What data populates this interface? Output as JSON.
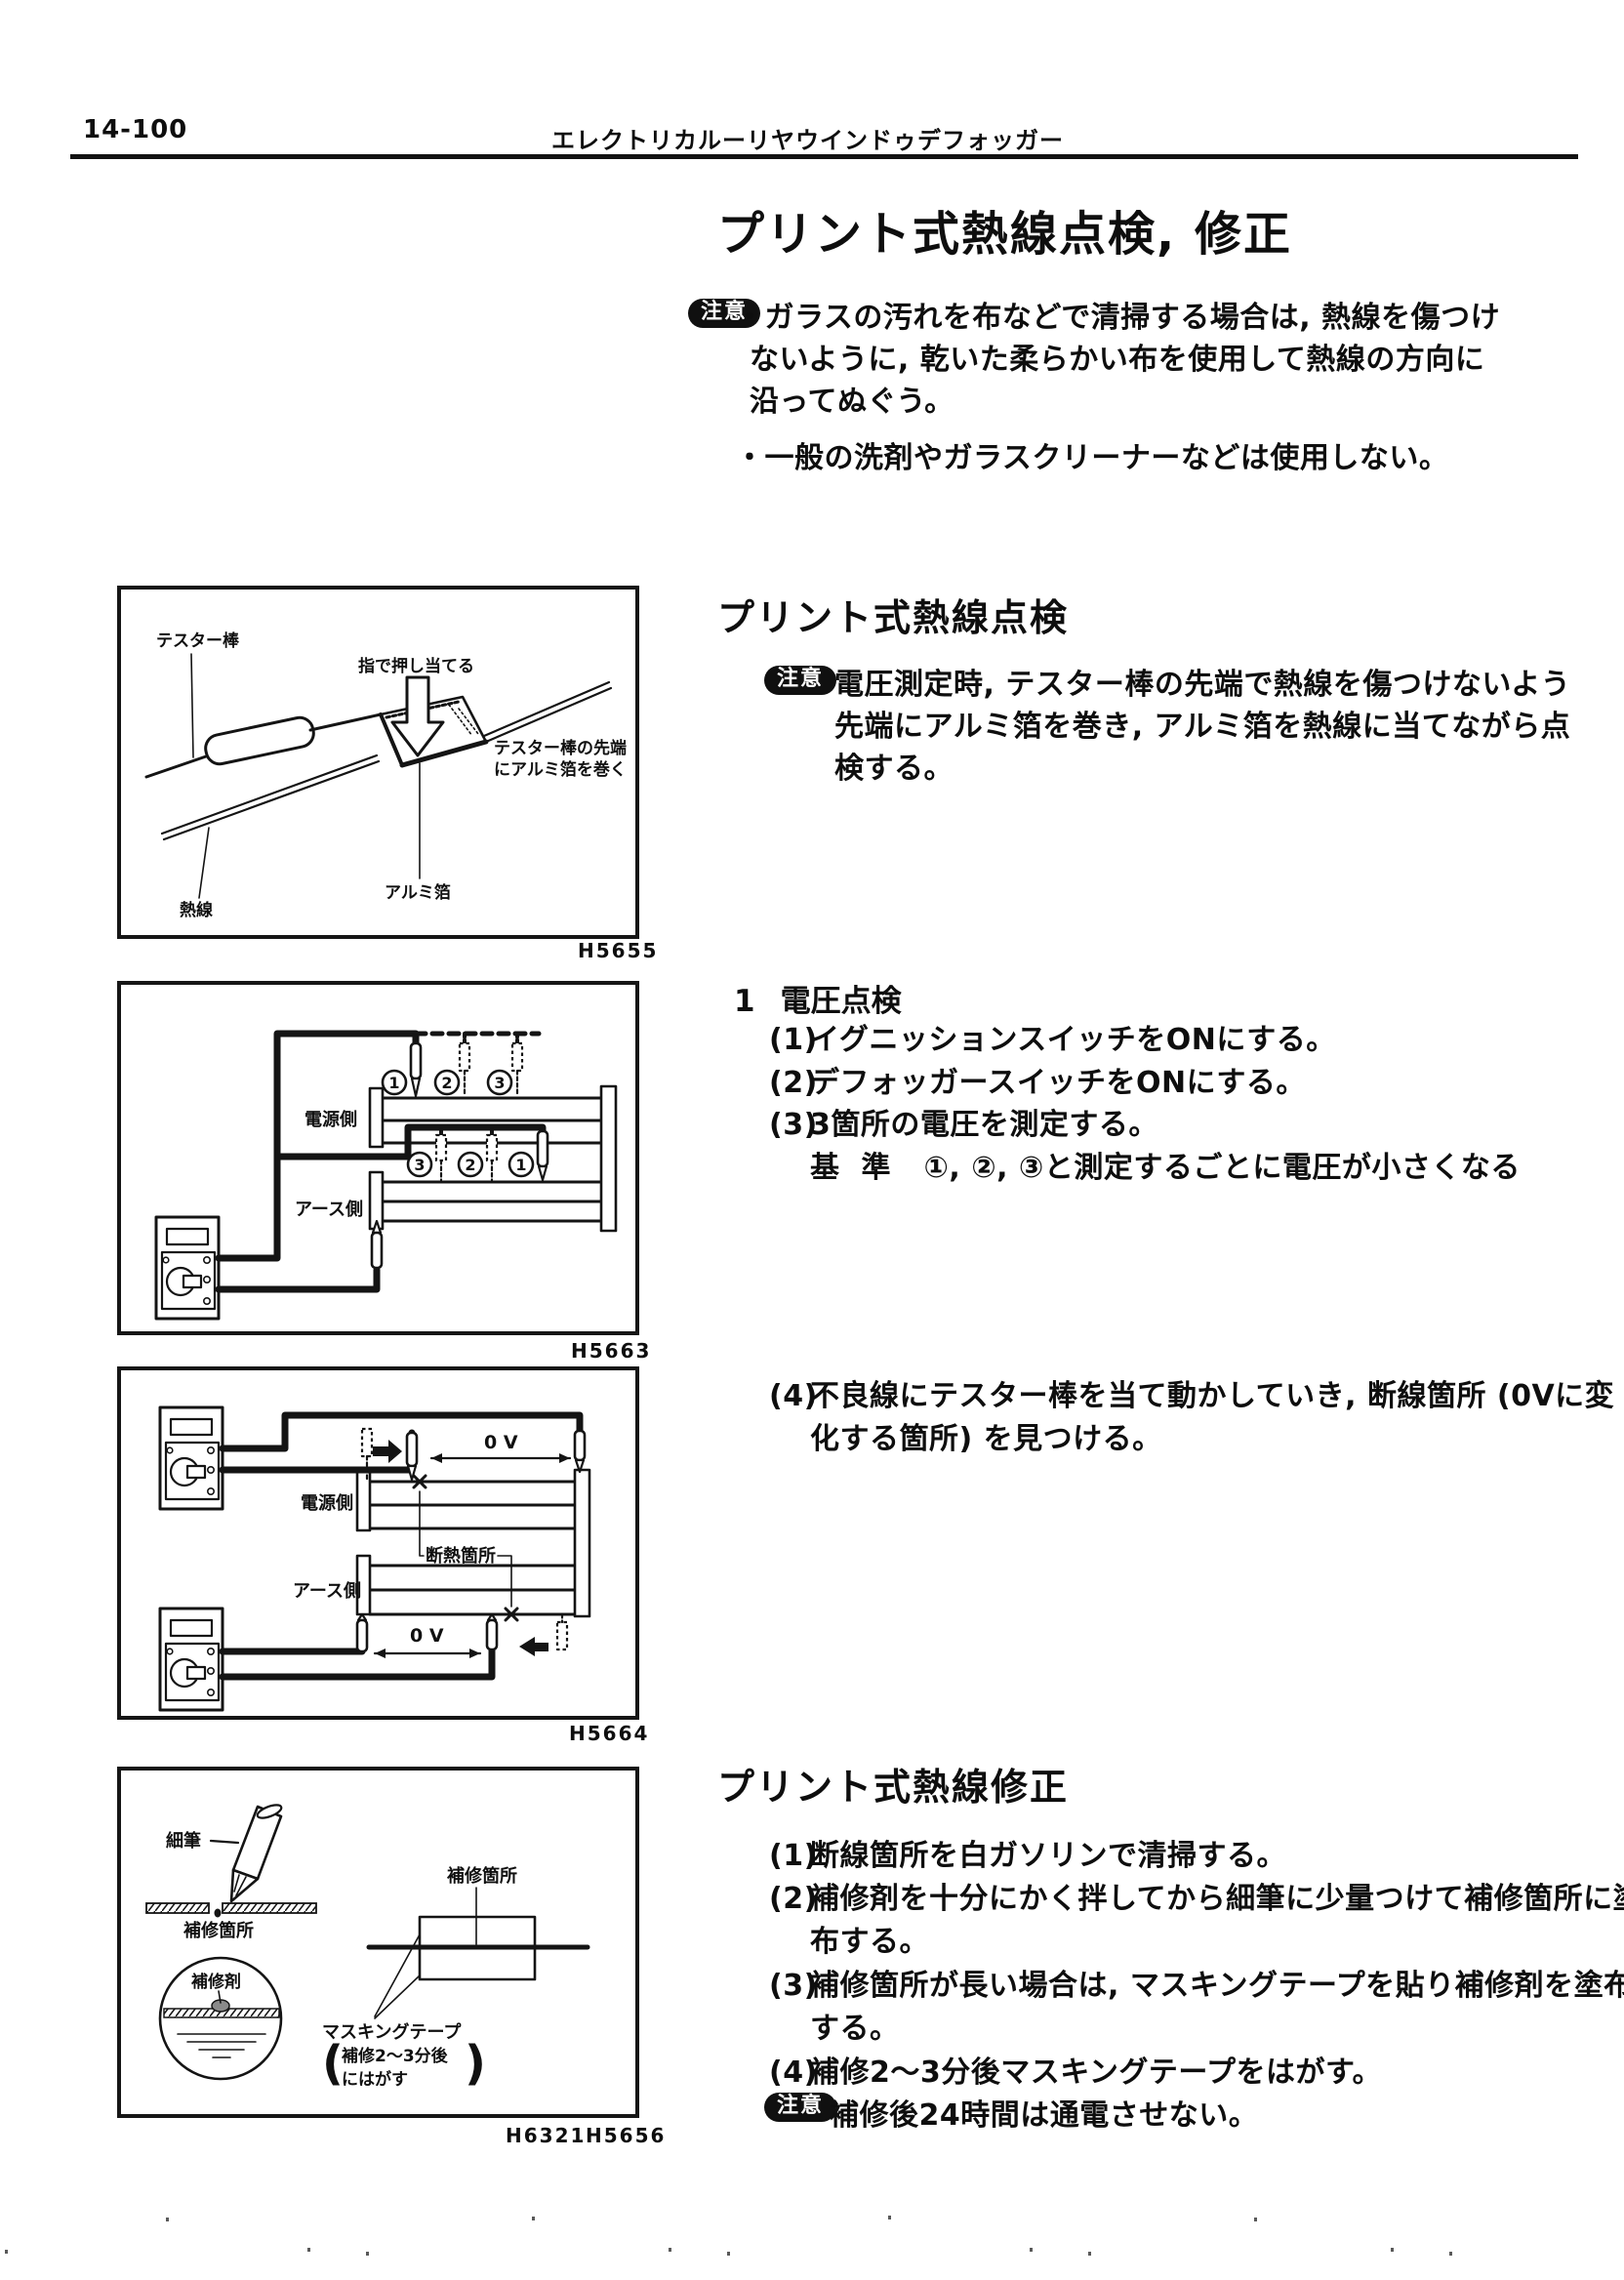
{
  "header": {
    "page_no": "14-100",
    "title": "エレクトリカルーリヤウインドゥデフォッガー"
  },
  "main_title": "プリント式熱線点検, 修正",
  "caution": "注意",
  "top_note": {
    "bullet": "・",
    "b1": [
      "ガラスの汚れを布などで清掃する場合は, 熱線を傷つけ",
      "ないように, 乾いた柔らかい布を使用して熱線の方向に",
      "沿ってぬぐう。"
    ],
    "b2": "一般の洗剤やガラスクリーナーなどは使用しない。"
  },
  "inspection": {
    "heading": "プリント式熱線点検",
    "note": [
      "電圧測定時, テスター棒の先端で熱線を傷つけないよう",
      "先端にアルミ箔を巻き, アルミ箔を熱線に当てながら点",
      "検する。"
    ],
    "sub_no": "1",
    "sub_title": "電圧点検",
    "steps": [
      {
        "no": "(1)",
        "text": "イグニッションスイッチをONにする。"
      },
      {
        "no": "(2)",
        "text": "デフォッガースイッチをONにする。"
      },
      {
        "no": "(3)",
        "text": "3箇所の電圧を測定する。"
      }
    ],
    "std_label": "基 準",
    "std_text": "①, ②, ③と測定するごとに電圧が小さくなる",
    "s4_no": "(4)",
    "s4_l1": "不良線にテスター棒を当て動かしていき, 断線箇所 (0Vに変",
    "s4_l2": "化する箇所) を見つける。"
  },
  "repair": {
    "heading": "プリント式熱線修正",
    "s1_no": "(1)",
    "s1": "断線箇所を白ガソリンで清掃する。",
    "s2_no": "(2)",
    "s2_l1": "補修剤を十分にかく拌してから細筆に少量つけて補修箇所に塗",
    "s2_l2": "布する。",
    "s3_no": "(3)",
    "s3_l1": "補修箇所が長い場合は, マスキングテープを貼り補修剤を塗布",
    "s3_l2": "する。",
    "s4_no": "(4)",
    "s4": "補修2〜3分後マスキングテープをはがす。",
    "note": "補修後24時間は通電させない。"
  },
  "figures": {
    "f1": {
      "code": "H5655",
      "tester": "テスター棒",
      "press": "指で押し当てる",
      "wrap1": "テスター棒の先端",
      "wrap2": "にアルミ箔を巻く",
      "foil": "アルミ箔",
      "wire": "熱線"
    },
    "f2": {
      "code": "H5663",
      "power": "電源側",
      "ground": "アース側",
      "c1": "1",
      "c2": "2",
      "c3": "3"
    },
    "f3": {
      "code": "H5664",
      "power": "電源側",
      "ground": "アース側",
      "volt": "0 V",
      "break_label": "断熱箇所"
    },
    "f4": {
      "code": "H6321",
      "code2": "H5656",
      "brush": "細筆",
      "spot": "補修箇所",
      "agent": "補修剤",
      "mask1": "マスキングテープ",
      "mask2": "補修2〜3分後",
      "mask3": "にはがす",
      "paren_l": "(",
      "paren_r": ")"
    }
  }
}
